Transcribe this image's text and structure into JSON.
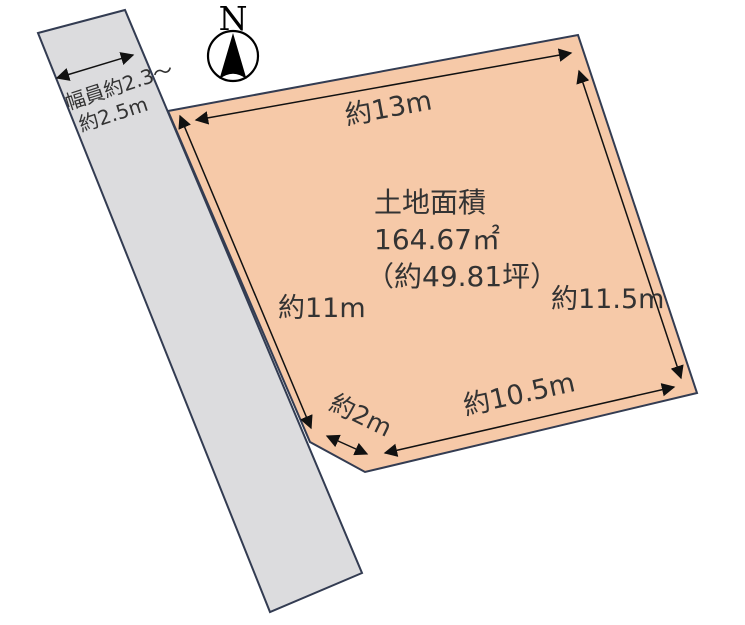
{
  "diagram": {
    "compass": {
      "north_label": "N"
    },
    "road": {
      "width_label_line1": "幅員約2.3〜",
      "width_label_line2": "約2.5m"
    },
    "parcel": {
      "area_title": "土地面積",
      "area_value": "164.67㎡",
      "area_tsubo": "（約49.81坪）",
      "dim_top": "約13m",
      "dim_left": "約11m",
      "dim_right": "約11.5m",
      "dim_bottom": "約10.5m",
      "dim_corner": "約2m"
    }
  },
  "colors": {
    "parcel_fill": "#f6c9a8",
    "road_fill": "#dcdcde",
    "boundary_stroke": "#333c52",
    "arrow_color": "#111111",
    "text_color": "#333333"
  }
}
